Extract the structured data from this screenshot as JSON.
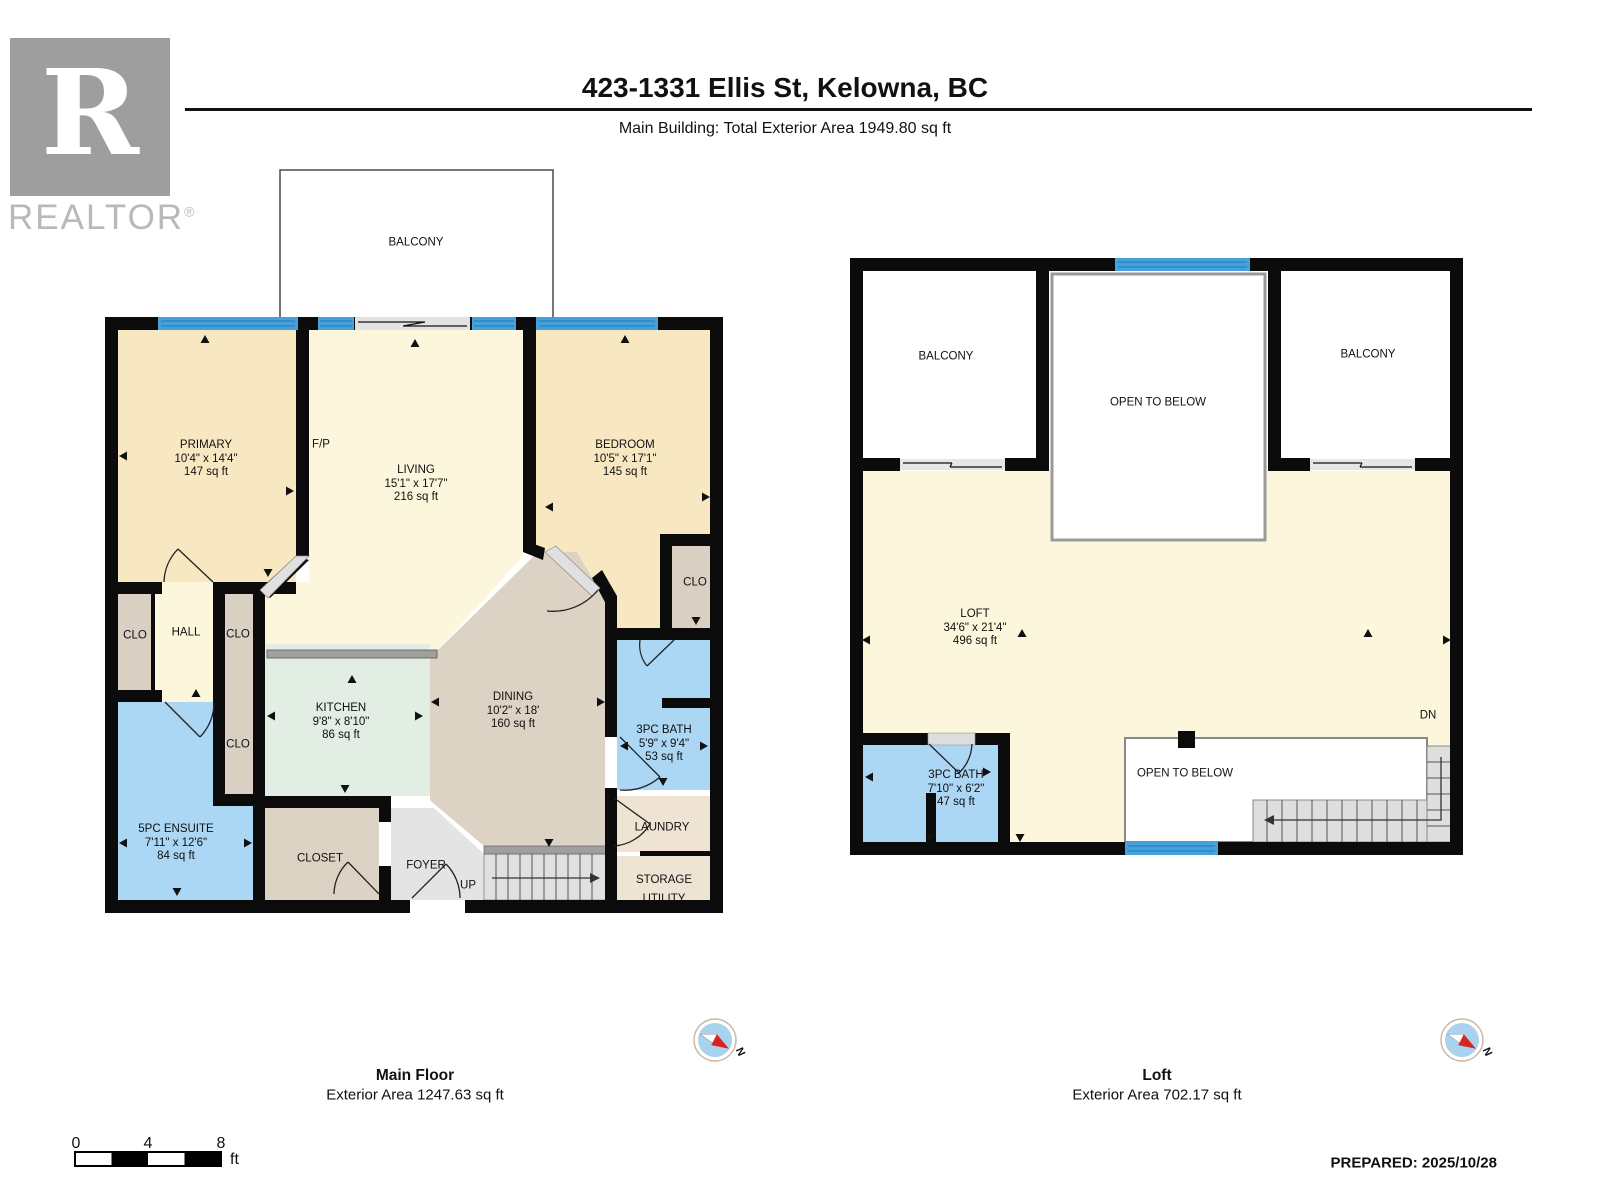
{
  "header": {
    "title": "423-1331 Ellis St, Kelowna, BC",
    "subtitle": "Main Building: Total Exterior Area 1949.80 sq ft",
    "logo": {
      "letter": "R",
      "text": "REALTOR",
      "reg": "®"
    }
  },
  "main_floor": {
    "title": "Main Floor",
    "subtitle": "Exterior Area 1247.63 sq ft",
    "rooms": {
      "balcony": {
        "name": "BALCONY"
      },
      "primary": {
        "name": "PRIMARY",
        "dims": "10'4\" x 14'4\"",
        "area": "147 sq ft"
      },
      "fireplace": {
        "name": "F/P"
      },
      "living": {
        "name": "LIVING",
        "dims": "15'1\" x 17'7\"",
        "area": "216 sq ft"
      },
      "bedroom": {
        "name": "BEDROOM",
        "dims": "10'5\" x 17'1\"",
        "area": "145 sq ft"
      },
      "clo_left": {
        "name": "CLO"
      },
      "hall": {
        "name": "HALL"
      },
      "clo_mid": {
        "name": "CLO"
      },
      "clo_lower": {
        "name": "CLO"
      },
      "clo_bedroom": {
        "name": "CLO"
      },
      "kitchen": {
        "name": "KITCHEN",
        "dims": "9'8\" x 8'10\"",
        "area": "86 sq ft"
      },
      "dining": {
        "name": "DINING",
        "dims": "10'2\" x 18'",
        "area": "160 sq ft"
      },
      "bath": {
        "name": "3PC BATH",
        "dims": "5'9\" x 9'4\"",
        "area": "53 sq ft"
      },
      "ensuite": {
        "name": "5PC ENSUITE",
        "dims": "7'11\" x 12'6\"",
        "area": "84 sq ft"
      },
      "closet": {
        "name": "CLOSET"
      },
      "foyer": {
        "name": "FOYER"
      },
      "stairs": {
        "name": "UP"
      },
      "laundry": {
        "name": "LAUNDRY"
      },
      "storage": {
        "name": "STORAGE"
      },
      "utility": {
        "name": "UTILITY"
      }
    }
  },
  "loft": {
    "title": "Loft",
    "subtitle": "Exterior Area 702.17 sq ft",
    "rooms": {
      "balcony_left": {
        "name": "BALCONY"
      },
      "balcony_right": {
        "name": "BALCONY"
      },
      "open_top": {
        "name": "OPEN TO BELOW"
      },
      "open_bottom": {
        "name": "OPEN TO BELOW"
      },
      "loft": {
        "name": "LOFT",
        "dims": "34'6\" x 21'4\"",
        "area": "496 sq ft"
      },
      "bath": {
        "name": "3PC BATH",
        "dims": "7'10\" x 6'2\"",
        "area": "47 sq ft"
      },
      "stairs": {
        "name": "DN"
      }
    }
  },
  "compass": {
    "label": "N"
  },
  "scale": {
    "t0": "0",
    "t1": "4",
    "t2": "8",
    "unit": "ft"
  },
  "footer": {
    "prepared": "PREPARED: 2025/10/28"
  },
  "colors": {
    "wall": "#0b0b0b",
    "bedroom_fill": "#F8E8C2",
    "living_fill": "#FBF6DC",
    "kitchen_fill": "#E2EDE3",
    "dining_fill": "#DDD3C5",
    "closet_fill": "#D9CFC3",
    "laundry_fill": "#EFE3D3",
    "bath_fill": "#ABD6F4",
    "foyer_fill": "#E4E4E4",
    "stair_fill": "#E0E0E0",
    "window_blue": "#45A1DC",
    "compass_blue": "#A9D2EE"
  }
}
